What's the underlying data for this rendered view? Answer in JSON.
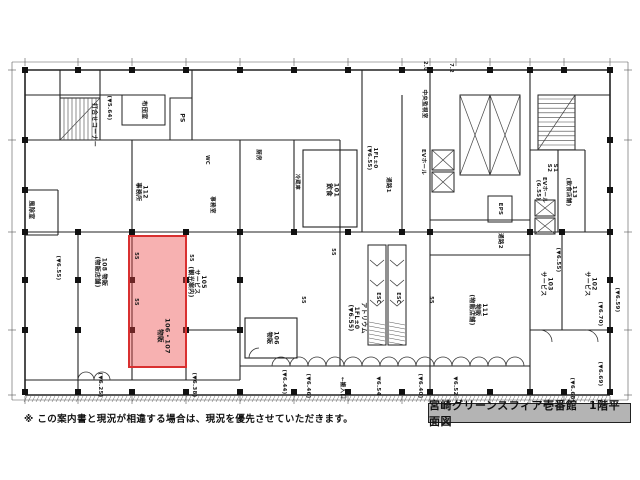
{
  "title_box": {
    "text": "宮崎グリーンスフィア壱番館　1階平面図"
  },
  "disclaimer": "※ この案内書と現況が相違する場合は、現況を優先させていただきます。",
  "highlight": {
    "unit": "106・107",
    "use": "物販",
    "color": "#d93030"
  },
  "labels": [
    {
      "t": "風除室",
      "x": 30,
      "y": 210,
      "r": 90,
      "s": 6
    },
    {
      "t": "打合せコーナー",
      "x": 93,
      "y": 125,
      "r": 90,
      "s": 6
    },
    {
      "t": "(▼5.64)",
      "x": 109,
      "y": 108,
      "r": 90,
      "s": 5.5
    },
    {
      "t": "布団室",
      "x": 143,
      "y": 110,
      "r": 90,
      "s": 6
    },
    {
      "t": "PS",
      "x": 181,
      "y": 118,
      "r": 90,
      "s": 6
    },
    {
      "t": "112\n事務所",
      "x": 141,
      "y": 192,
      "r": 90,
      "s": 6
    },
    {
      "t": "WC",
      "x": 206,
      "y": 160,
      "r": 90,
      "s": 5
    },
    {
      "t": "厨房",
      "x": 258,
      "y": 155,
      "r": 90,
      "s": 5.5
    },
    {
      "t": "事務室",
      "x": 212,
      "y": 205,
      "r": 90,
      "s": 5.5
    },
    {
      "t": "冷蔵庫",
      "x": 296,
      "y": 182,
      "r": 90,
      "s": 5
    },
    {
      "t": "101\n飲食",
      "x": 332,
      "y": 190,
      "r": 90,
      "s": 6.5
    },
    {
      "t": "1FL±0\n(▼6.55)",
      "x": 372,
      "y": 158,
      "r": 90,
      "s": 5.5
    },
    {
      "t": "通路1",
      "x": 388,
      "y": 185,
      "r": 90,
      "s": 5.5
    },
    {
      "t": "中央監視室",
      "x": 424,
      "y": 104,
      "r": 90,
      "s": 5.5
    },
    {
      "t": "EVホール",
      "x": 423,
      "y": 162,
      "r": 90,
      "s": 5.5
    },
    {
      "t": "EPS",
      "x": 500,
      "y": 209,
      "r": 90,
      "s": 5.5
    },
    {
      "t": "通路2",
      "x": 500,
      "y": 241,
      "r": 90,
      "s": 5.5
    },
    {
      "t": "EVホール\n(6.55)",
      "x": 541,
      "y": 190,
      "r": 90,
      "s": 5.5
    },
    {
      "t": "S1\nS2",
      "x": 552,
      "y": 168,
      "r": 90,
      "s": 5.5
    },
    {
      "t": "113\n(飲食店舗)",
      "x": 571,
      "y": 192,
      "r": 90,
      "s": 5.5
    },
    {
      "t": "(▼6.55)",
      "x": 58,
      "y": 268,
      "r": 90,
      "s": 5.5
    },
    {
      "t": "108 物販\n(物販店舗)",
      "x": 100,
      "y": 272,
      "r": 90,
      "s": 6
    },
    {
      "t": "105\nサービス\n(観光案内)",
      "x": 196,
      "y": 282,
      "r": 90,
      "s": 6
    },
    {
      "t": "106・107\n物販",
      "x": 163,
      "y": 336,
      "r": 90,
      "s": 6.5
    },
    {
      "t": "106\n物販",
      "x": 272,
      "y": 338,
      "r": 90,
      "s": 6
    },
    {
      "t": "アトリウム\n1FL±0\n(▼6.55)",
      "x": 356,
      "y": 318,
      "r": 90,
      "s": 6
    },
    {
      "t": "ESC",
      "x": 377,
      "y": 298,
      "r": 90,
      "s": 5
    },
    {
      "t": "ESC",
      "x": 397,
      "y": 298,
      "r": 90,
      "s": 5
    },
    {
      "t": "111\n物販\n(物販店舗)",
      "x": 477,
      "y": 310,
      "r": 90,
      "s": 6
    },
    {
      "t": "103\nサービス",
      "x": 546,
      "y": 284,
      "r": 90,
      "s": 6
    },
    {
      "t": "(▼6.55)",
      "x": 558,
      "y": 260,
      "r": 90,
      "s": 5.5
    },
    {
      "t": "102\nサービス",
      "x": 590,
      "y": 284,
      "r": 90,
      "s": 6
    },
    {
      "t": "(▼6.70)",
      "x": 600,
      "y": 314,
      "r": 90,
      "s": 5.5
    },
    {
      "t": "(▼6.59)",
      "x": 617,
      "y": 300,
      "r": 90,
      "s": 5.5
    },
    {
      "t": "(▼6.25)",
      "x": 100,
      "y": 385,
      "r": 90,
      "s": 5.5
    },
    {
      "t": "(▼6.38)",
      "x": 194,
      "y": 385,
      "r": 90,
      "s": 5.5
    },
    {
      "t": "(▼6.44)",
      "x": 284,
      "y": 382,
      "r": 90,
      "s": 5.5
    },
    {
      "t": "(▼6.46)",
      "x": 308,
      "y": 386,
      "r": 90,
      "s": 5.5
    },
    {
      "t": "←搬入口",
      "x": 342,
      "y": 388,
      "r": 90,
      "s": 5.5
    },
    {
      "t": "▼6.54",
      "x": 378,
      "y": 386,
      "r": 90,
      "s": 5.5
    },
    {
      "t": "(▼6.40)",
      "x": 420,
      "y": 386,
      "r": 90,
      "s": 5.5
    },
    {
      "t": "▼6.52",
      "x": 455,
      "y": 386,
      "r": 90,
      "s": 5.5
    },
    {
      "t": "(▼6.68)",
      "x": 572,
      "y": 390,
      "r": 90,
      "s": 5.5
    },
    {
      "t": "(▼6.69)",
      "x": 600,
      "y": 374,
      "r": 90,
      "s": 5.5
    },
    {
      "t": "55",
      "x": 135,
      "y": 256,
      "r": 90,
      "s": 5
    },
    {
      "t": "55",
      "x": 135,
      "y": 302,
      "r": 90,
      "s": 5
    },
    {
      "t": "55",
      "x": 190,
      "y": 258,
      "r": 90,
      "s": 5
    },
    {
      "t": "55",
      "x": 302,
      "y": 300,
      "r": 90,
      "s": 5
    },
    {
      "t": "55",
      "x": 332,
      "y": 252,
      "r": 90,
      "s": 5
    },
    {
      "t": "55",
      "x": 430,
      "y": 300,
      "r": 90,
      "s": 5
    },
    {
      "t": "2.0",
      "x": 424,
      "y": 66,
      "r": 90,
      "s": 5
    },
    {
      "t": "7.2",
      "x": 450,
      "y": 68,
      "r": 90,
      "s": 5
    }
  ]
}
